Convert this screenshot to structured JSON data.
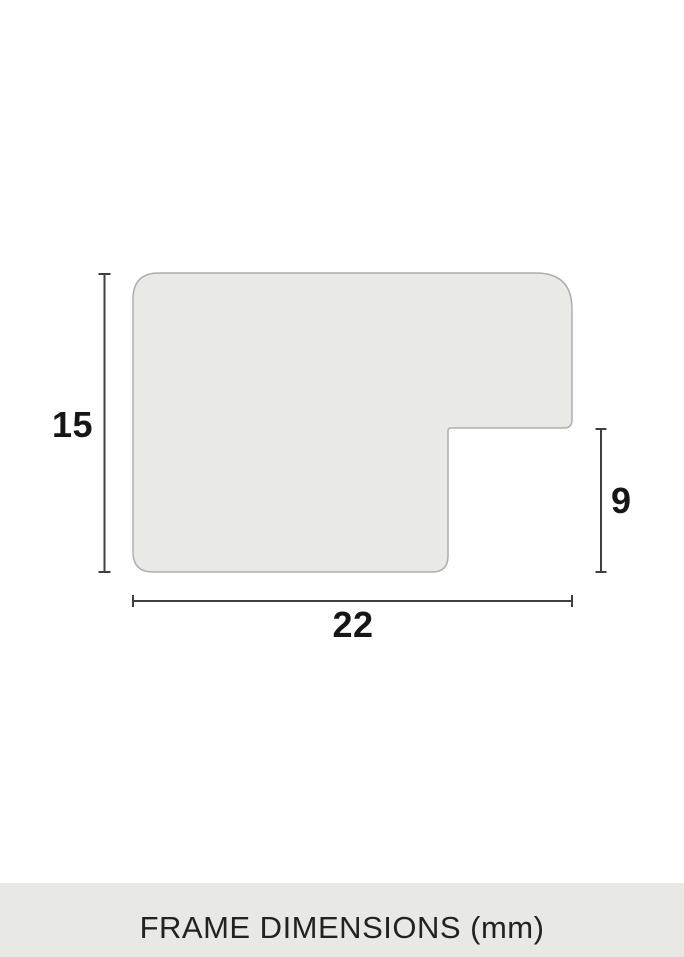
{
  "diagram": {
    "height_label": "15",
    "rabbet_label": "9",
    "width_label": "22",
    "profile_fill": "#e9e9e5",
    "profile_stroke": "#aeaeaa",
    "line_color": "#3f3f3f",
    "label_color": "#161616"
  },
  "footer": {
    "title": "FRAME DIMENSIONS (mm)",
    "background": "#e8e8e4",
    "text_color": "#222222"
  }
}
